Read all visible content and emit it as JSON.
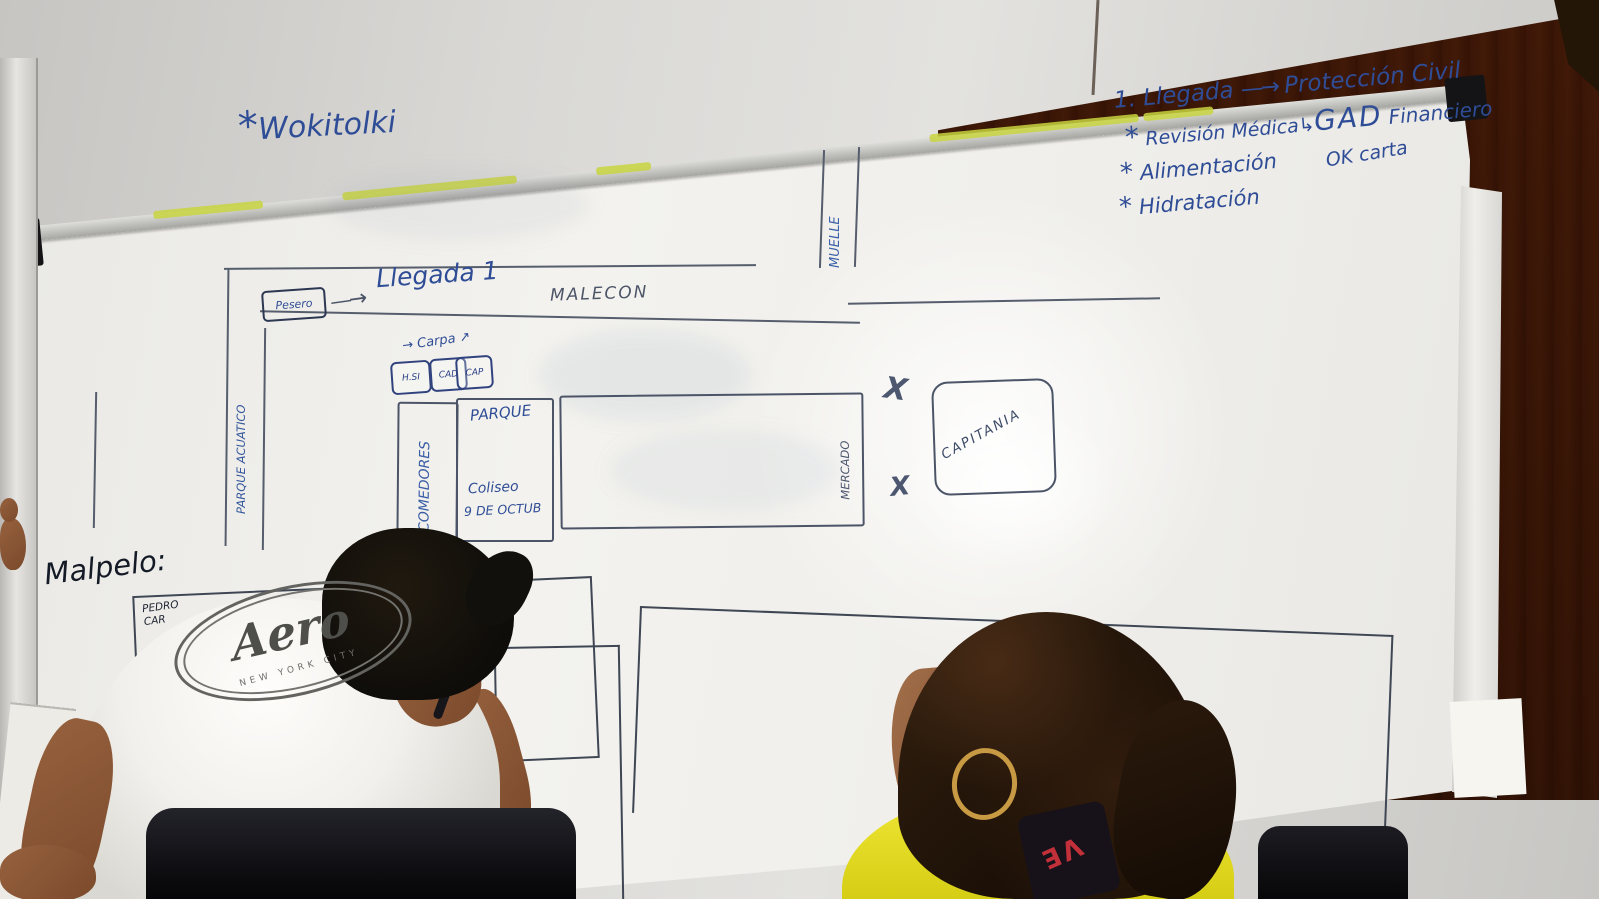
{
  "board": {
    "walkie": {
      "bullet": "*",
      "label": "Wokitolki"
    },
    "plan": {
      "line1_num": "1.",
      "line1_label": "Llegada",
      "line1_target": "Protección Civil",
      "line2_bullet": "*",
      "line2_label": "Revisión Médica",
      "line2_target_main": "GAD",
      "line2_target_rest": "Financiero",
      "line3_bullet": "*",
      "line3_label": "Alimentación",
      "line3_note": "OK carta",
      "line4_bullet": "*",
      "line4_label": "Hidratación"
    },
    "map": {
      "pesero": "Pesero",
      "llegada": "Llegada 1",
      "malecon": "MALECON",
      "muelle": "MUELLE",
      "parque_acuatico": "PARQUE ACUATICO",
      "carpa": "Carpa",
      "tents": [
        "H.SI",
        "CAD",
        "CAP"
      ],
      "comedores": "COMEDORES",
      "parque": "PARQUE",
      "coliseo_1": "Coliseo",
      "coliseo_2": "9 DE OCTUB",
      "mercado": "MERCADO",
      "capitania": "CAPITANIA",
      "x_mark": "X",
      "malpelo": "Malpelo:",
      "pedro_1": "PEDRO",
      "pedro_2": "CAR",
      "via": "VIA"
    }
  },
  "icons": {
    "arrow_long": "—→",
    "arrow_right": "→",
    "arrow_up_right": "↗",
    "arrow_hook": "↳"
  },
  "shirt_logo": {
    "brand": "Aero",
    "subtitle": "NEW YORK CITY"
  },
  "lanyard": {
    "letters": "VE"
  },
  "colors": {
    "marker_blue": "#2f4d96",
    "marker_dark": "#4c5568",
    "ink_black": "#1c2230",
    "rail_highlight": "#c8d43f",
    "shirt_yellow": "#e8df2e",
    "wood_brown": "#7a4a28",
    "earring_gold": "#c89a43",
    "lanyard_red": "#c2303a"
  }
}
